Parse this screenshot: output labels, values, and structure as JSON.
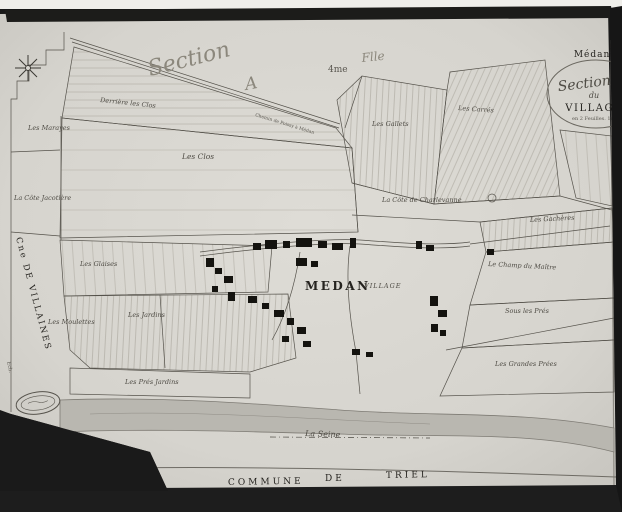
{
  "sheet": {
    "section_script": "Section",
    "section_letter": "A",
    "sheet_no": "4me",
    "sheet_word": "Flle"
  },
  "cartouche": {
    "commune": "Médan.",
    "section_line": "Section A",
    "du": "du",
    "village": "VILLAGE",
    "note": "en 2 Feuilles. 1re"
  },
  "village": {
    "name": "MEDAN",
    "suffix": "VILLAGE"
  },
  "parcels": {
    "derriere_les_clos": "Derrière les Clos",
    "les_marayes": "Les Marayes",
    "les_clos": "Les Clos",
    "la_cote_jacotiere": "La Côte Jacotière",
    "les_gallets": "Les Gallets",
    "les_carres": "Les Carrés",
    "la_cote_de_charlevanne": "La Côte de Charlevanne",
    "les_gacheres": "Les Gachères",
    "le_champ_du_maitre": "Le Champ du Maître",
    "sous_les_pres": "Sous les Prés",
    "les_grandes_prees": "Les Grandes Prées",
    "les_glaises": "Les Glaises",
    "les_moulettes": "Les Moulettes",
    "les_jardins": "Les Jardins",
    "les_pres_jardins": "Les Prés Jardins"
  },
  "roads": {
    "top_road": "Chemin de Poissy à Médan"
  },
  "river": {
    "name": "La Seine"
  },
  "neighbors": {
    "west": "Cne DE VILLAINES",
    "south_word1": "COMMUNE",
    "south_word2": "DE",
    "south_word3": "TRIEL"
  },
  "margin": {
    "scale_note": "Ech."
  },
  "colors": {
    "paper": "#d8d6d0",
    "frame": "#181818",
    "line": "#55524b",
    "hatch": "#a19d93",
    "river_fill": "#b9b7b0",
    "building": "#14130f"
  }
}
